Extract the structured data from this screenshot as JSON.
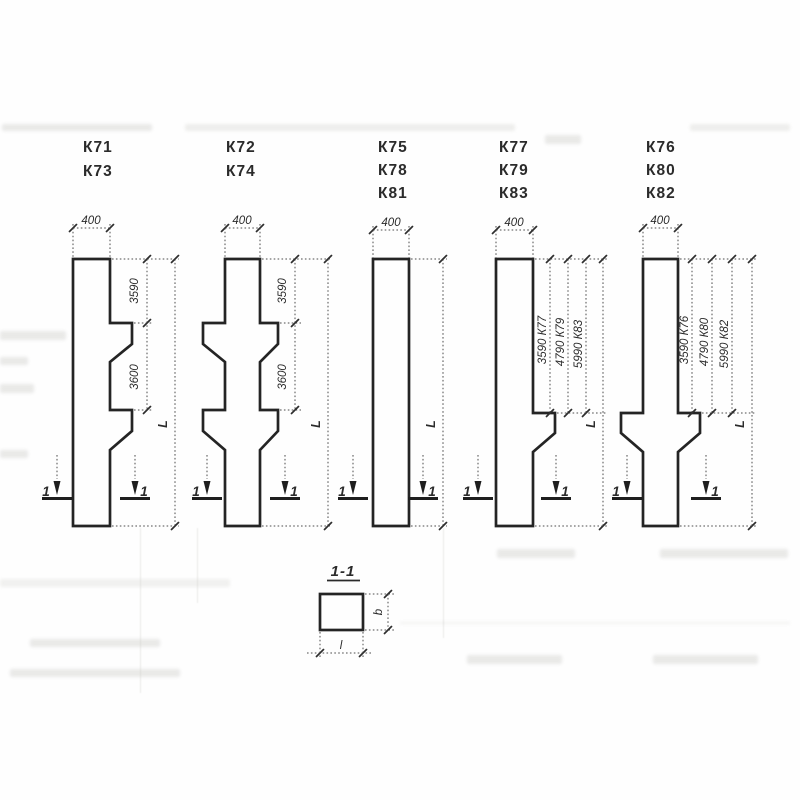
{
  "drawing": {
    "columns": [
      {
        "marks": [
          "К71",
          "К73"
        ],
        "top_width": "400",
        "dim_labels": [
          "3590",
          "3600"
        ],
        "length_label": "L"
      },
      {
        "marks": [
          "К72",
          "К74"
        ],
        "top_width": "400",
        "dim_labels": [
          "3590",
          "3600"
        ],
        "length_label": "L"
      },
      {
        "marks": [
          "К75",
          "К78",
          "К81"
        ],
        "top_width": "400",
        "dim_labels": [],
        "length_label": "L"
      },
      {
        "marks": [
          "К77",
          "К79",
          "К83"
        ],
        "top_width": "400",
        "dim_labels": [
          "3590 К77",
          "4790 К79",
          "5990 К83"
        ],
        "length_label": "L"
      },
      {
        "marks": [
          "К76",
          "К80",
          "К82"
        ],
        "top_width": "400",
        "dim_labels": [
          "3590 К76",
          "4790 К80",
          "5990 К82"
        ],
        "length_label": "L"
      }
    ],
    "section_cut_label": "1",
    "section_view": {
      "title": "1-1",
      "height_label": "b",
      "width_label": "l"
    },
    "ink_color": "#2b2b2b",
    "paper_color": "#fefefe"
  }
}
